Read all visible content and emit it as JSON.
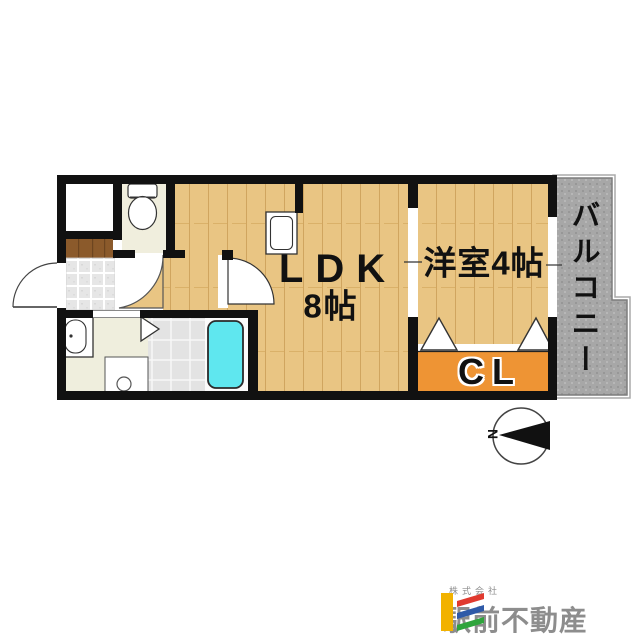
{
  "plan": {
    "rooms": {
      "ldk": {
        "label": "LDK",
        "size": "8帖"
      },
      "western_room": {
        "label": "洋室4帖"
      },
      "closet": {
        "label": "CL"
      },
      "balcony": {
        "label": "バルコニー"
      }
    },
    "compass": {
      "north_label": "N"
    },
    "colors": {
      "wood_floor": "#e9c583",
      "closet_orange": "#ee9434",
      "bathtub_cyan": "#5fe7ef",
      "balcony_gray": "#a7a7a7",
      "washroom_cream": "#efeedd",
      "toilet_room_cream": "#f0eedd",
      "entry_step_brown": "#8b5a2b",
      "wall_black": "#111111"
    },
    "fixtures": [
      "toilet",
      "kitchen-sink",
      "washbasin",
      "washing-machine-pan",
      "bathtub",
      "entrance-door",
      "closet-folding-doors",
      "compass"
    ]
  },
  "logo": {
    "company_prefix": "株式会社",
    "company_name": "駅前不動産",
    "colors": {
      "bar_yellow": "#f2b200",
      "stripe_red": "#e03a2f",
      "stripe_blue": "#2f5aa8",
      "stripe_green": "#2fa43c",
      "text_gray": "#8d8d8d"
    }
  }
}
